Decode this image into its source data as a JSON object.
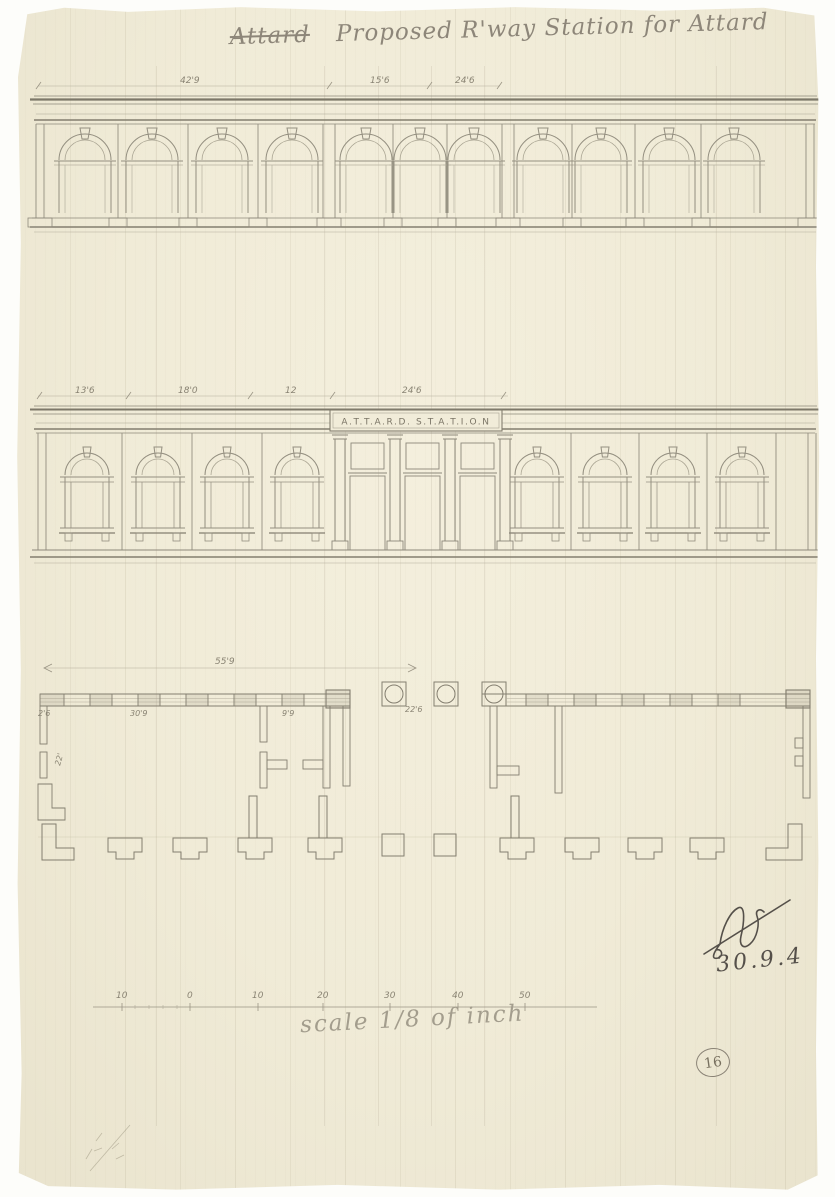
{
  "title": {
    "struck_word": "Attard",
    "text": "Proposed R'way Station for Attard"
  },
  "top_elevation": {
    "dimensions": [
      "42'9",
      "15'6",
      "24'6"
    ]
  },
  "middle_elevation": {
    "dimensions": [
      "13'6",
      "18'0",
      "12",
      "24'6"
    ],
    "sign_text": "A.T.T.A.R.D. S.T.A.T.I.O.N"
  },
  "plan": {
    "overall_width": "55'9",
    "wall_thickness": "2'6",
    "room_width": "30'9",
    "lobby_width": "9'9",
    "column_bay": "22'6",
    "depth": "22'"
  },
  "signature": {
    "date": "30.9.4"
  },
  "scale_bar": {
    "labels": [
      "10",
      "0",
      "10",
      "20",
      "30",
      "40",
      "50"
    ],
    "caption": "scale 1/8 of inch"
  },
  "page_number": "16"
}
